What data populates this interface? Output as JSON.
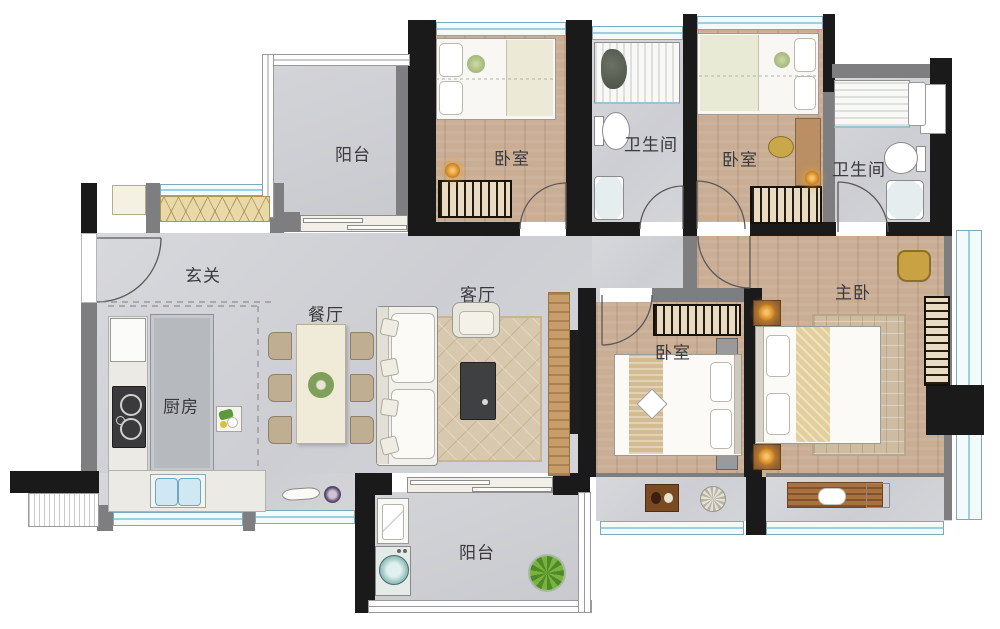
{
  "floorplan": {
    "title": "apartment-floor-plan",
    "rooms": [
      {
        "key": "balcony-top",
        "label": "阳台"
      },
      {
        "key": "bedroom-1",
        "label": "卧室"
      },
      {
        "key": "bathroom-1",
        "label": "卫生间"
      },
      {
        "key": "bedroom-2",
        "label": "卧室"
      },
      {
        "key": "bathroom-2",
        "label": "卫生间"
      },
      {
        "key": "entry",
        "label": "玄关"
      },
      {
        "key": "dining",
        "label": "餐厅"
      },
      {
        "key": "living",
        "label": "客厅"
      },
      {
        "key": "kitchen",
        "label": "厨房"
      },
      {
        "key": "bedroom-3",
        "label": "卧室"
      },
      {
        "key": "master-bedroom",
        "label": "主卧"
      },
      {
        "key": "balcony-bottom",
        "label": "阳台"
      }
    ],
    "colors": {
      "wall": "#1a1a1a",
      "wall_light": "#7e7e80",
      "window_glass": "#9ccfe0",
      "tile_floor": "#d2d3d7",
      "wood_floor": "#c9ad94",
      "wardrobe_stripe": "#e8dbc2",
      "rug": "#d8c9ae",
      "lamp_accent": "#d98f2a",
      "washer_accent": "#bfe0df"
    }
  }
}
